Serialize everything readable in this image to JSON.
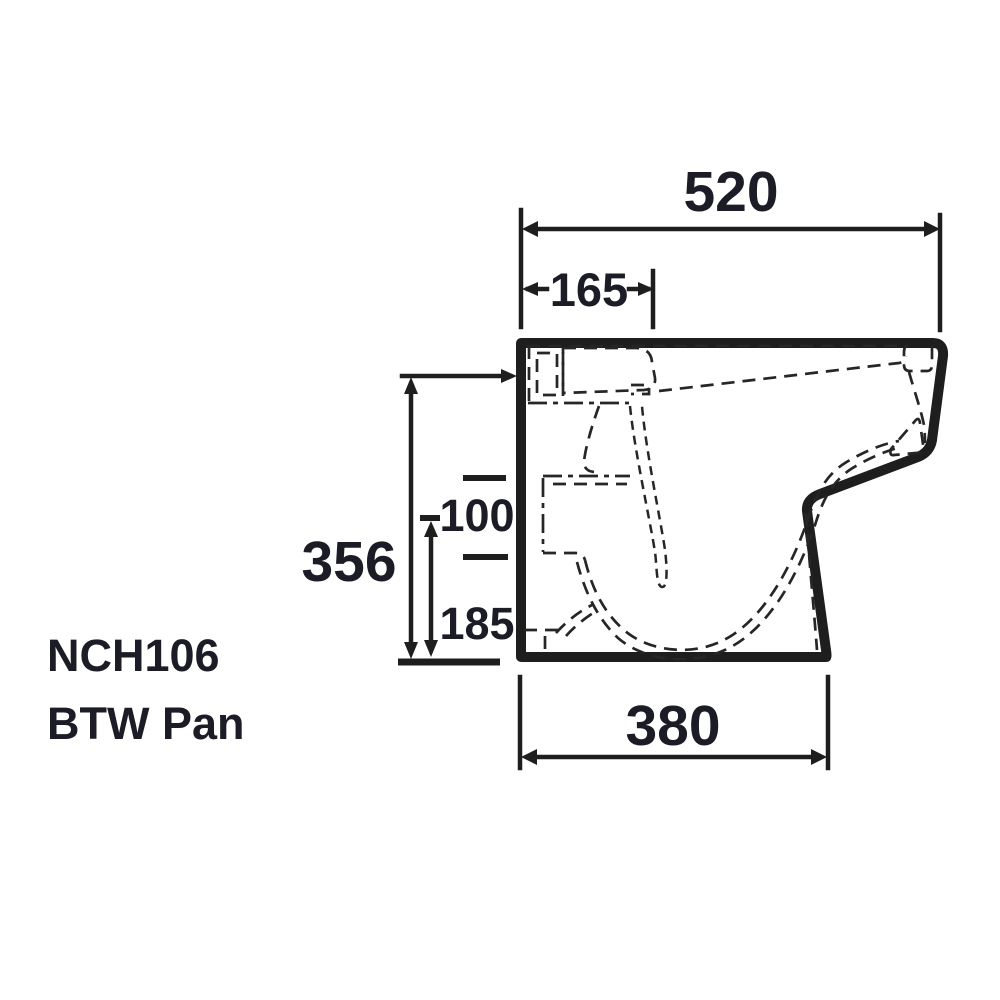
{
  "product": {
    "model": "NCH106",
    "type": "BTW Pan"
  },
  "dimensions": {
    "overall_depth": "520",
    "cistern_offset": "165",
    "pan_height": "356",
    "outlet_spacing": "100",
    "outlet_height": "185",
    "base_depth": "380"
  },
  "colors": {
    "ink": "#1e1e1e",
    "label_ink": "#1c1c26",
    "background": "#ffffff"
  }
}
